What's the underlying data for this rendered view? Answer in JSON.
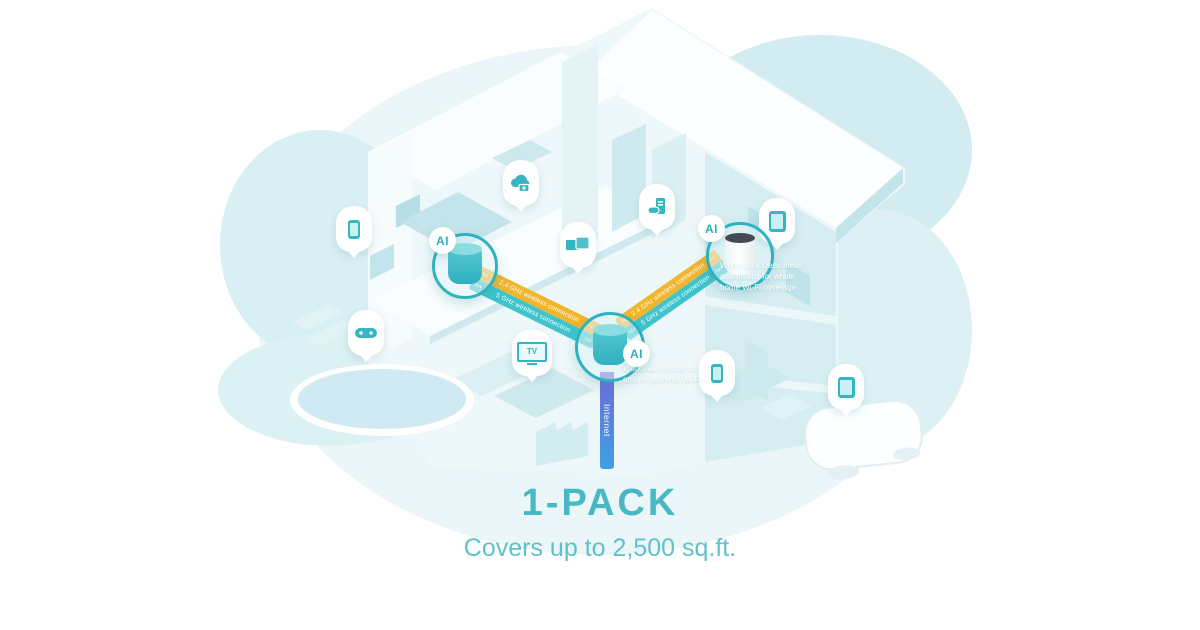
{
  "caption": {
    "title": "1-PACK",
    "subtitle": "Covers up to 2,500 sq.ft."
  },
  "ai_badge": "AI",
  "connections": {
    "band_24ghz_label": "2.4 GHz wireless connection",
    "band_5ghz_label": "5 GHz wireless connection",
    "chevrons": "›››",
    "internet_label": "Internet"
  },
  "annotations": {
    "router_note": "Works as a router to ensure powerful Wi-Fi",
    "addon_note": "Works as a Deco mesh add-on unit for whole home Wi-Fi coverage"
  },
  "devices": {
    "tv_label": "TV",
    "pins": [
      "smartphone",
      "cloud-camera",
      "dual-monitor",
      "gaming-pc",
      "gamepad",
      "tv",
      "tablet",
      "smartphone",
      "tablet"
    ]
  },
  "colors": {
    "accent_teal": "#35b6c2",
    "band_yellow": "#f1b52e",
    "band_teal": "#3fc4cc",
    "internet_gradient_top": "#6f6ad9",
    "internet_gradient_bottom": "#3fa1e4",
    "title_color": "#48b8c4",
    "subtitle_color": "#5ec2cb"
  }
}
